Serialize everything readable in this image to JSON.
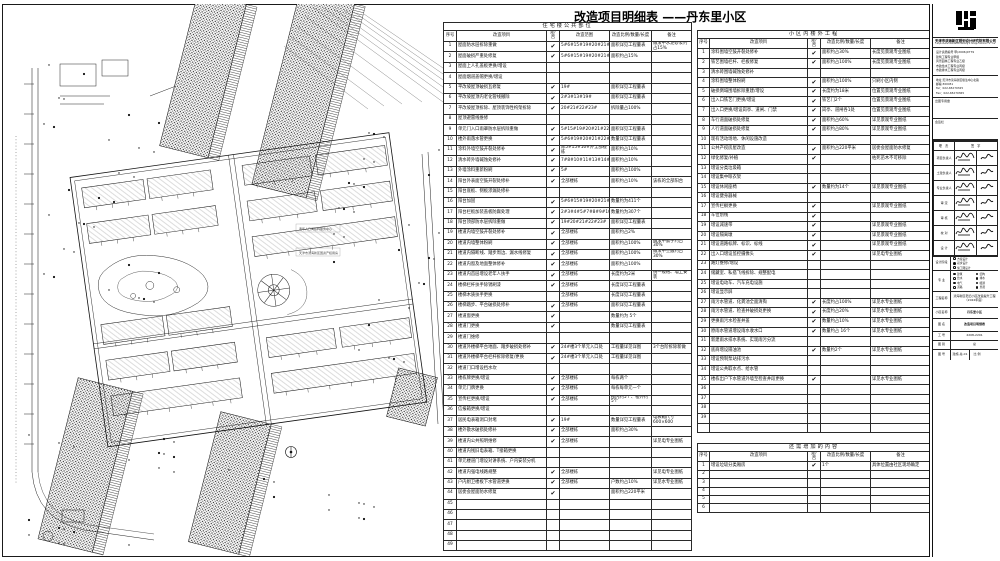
{
  "title": {
    "main": "改造项目明细表",
    "suffix": "——丹东里小区"
  },
  "left_table": {
    "title": "住宅楼公共部位",
    "headers": [
      "序号",
      "改造项目",
      "是/否",
      "改造范围",
      "改造比例/数量/长度",
      "备注"
    ],
    "rows": [
      [
        "1",
        "屋面防水层拆除重做",
        "✔",
        "5#6#15#19#20#21#22#23#",
        "面积详见工程量表",
        "做法中水泥砂浆约占15%"
      ],
      [
        "2",
        "屋面破损严重处修复",
        "✔",
        "5#6#15#19#20#21#22#23#",
        "面积约占15%",
        ""
      ],
      [
        "3",
        "屋面上人孔盖板更换/增设",
        "",
        "",
        "",
        ""
      ],
      [
        "4",
        "屋面烟道盖帽更换/增设",
        "",
        "",
        "",
        ""
      ],
      [
        "5",
        "平改坡屋顶破损瓦修复",
        "✔",
        "19#",
        "面积详见工程量表",
        ""
      ],
      [
        "6",
        "平改坡屋顶内老化管线撤除",
        "✔",
        "2#3#13#19#",
        "面积详见工程量表",
        ""
      ],
      [
        "7",
        "平改坡屋顶拆除、屋顶装饰性构架拆除",
        "✔",
        "20#21#22#23#",
        "拆除量占100%",
        ""
      ],
      [
        "8",
        "屋顶避雷线维修",
        "",
        "",
        "",
        ""
      ],
      [
        "9",
        "单元门入口雨罩防水层拆除重做",
        "✔",
        "5#15#19#20#21#22#23#",
        "面积详见工程量表",
        ""
      ],
      [
        "10",
        "楼外雨落水管更换",
        "✔",
        "5#6#19#20#21#22#23#",
        "数量详见工程量表",
        ""
      ],
      [
        "11",
        "涂料外墙空鼓开裂处修补",
        "✔",
        "除5#15#16#外全部楼栋",
        "面积约占10%",
        ""
      ],
      [
        "12",
        "清水砖外墙碱蚀处修补",
        "✔",
        "7#8#10#11#13#14#16#",
        "面积约占10%",
        ""
      ],
      [
        "13",
        "外墙涂料重新粉刷",
        "✔",
        "5#",
        "面积约占100%",
        ""
      ],
      [
        "14",
        "阳台外表面空鼓开裂处修补",
        "✔",
        "全部楼栋",
        "面积约占10%",
        "该栋的全部阳台"
      ],
      [
        "15",
        "阳台底板、侧板渗漏处修补",
        "",
        "",
        "",
        ""
      ],
      [
        "16",
        "阳台加固",
        "✔",
        "5#6#15#19#20#21#22#23#",
        "数量约为411个",
        ""
      ],
      [
        "17",
        "阳台栏板加装盖板防腐处理",
        "✔",
        "2#3#4#5#7#8#9#10#11#13#14#16#17#",
        "数量约为307个",
        ""
      ],
      [
        "18",
        "阳台顶部防水层拆除重做",
        "✔",
        "19#20#21#22#23#",
        "面积详见工程量表",
        ""
      ],
      [
        "19",
        "楼道内墙空鼓开裂处修补",
        "✔",
        "全部楼栋",
        "面积约占2%",
        ""
      ],
      [
        "20",
        "楼道内墙整体粉刷",
        "✔",
        "全部楼栋",
        "面积约占100%",
        "做法中腻子约占30%"
      ],
      [
        "21",
        "楼道内隔断线、踏步周边、漏水线修复",
        "✔",
        "全部楼栋",
        "面积约占100%",
        "做法中空鼓约占30%"
      ],
      [
        "22",
        "楼道内窗及地面整体修补",
        "✔",
        "全部楼栋",
        "面积约占100%",
        ""
      ],
      [
        "23",
        "楼道内首层增设老年人扶手",
        "✔",
        "全部楼栋",
        "长度约为2米",
        "统一规格、墙上安装"
      ],
      [
        "24",
        "楼梯栏杆扶手除锈刷漆",
        "✔",
        "全部楼栋",
        "长度详见工程量表",
        ""
      ],
      [
        "25",
        "楼梯木质扶手更换",
        "",
        "全部楼栋",
        "长度详见工程量表",
        ""
      ],
      [
        "26",
        "楼梯踏步、平台破损处修补",
        "✔",
        "全部楼栋",
        "面积详见工程量表",
        ""
      ],
      [
        "27",
        "楼道窗更换",
        "✔",
        "",
        "数量约为 5个",
        ""
      ],
      [
        "28",
        "楼道门更换",
        "✔",
        "",
        "数量详见工程量表",
        ""
      ],
      [
        "29",
        "楼道门维修",
        "",
        "",
        "",
        ""
      ],
      [
        "30",
        "楼道外楼梯平台地面、踏步破损处修补",
        "✔",
        "24#楼3个单元入口处",
        "工程量详见详图",
        "3个台阶拆除新做"
      ],
      [
        "31",
        "楼道外楼梯平台栏杆拆除修复/更换",
        "✔",
        "24#楼3个单元入口处",
        "工程量详见详图",
        ""
      ],
      [
        "32",
        "楼道门口增设挡水坎",
        "",
        "",
        "",
        ""
      ],
      [
        "33",
        "楼栋牌更换/增设",
        "✔",
        "全部楼栋",
        "每栋两个",
        ""
      ],
      [
        "34",
        "单元门牌更换",
        "✔",
        "全部楼栋",
        "每栋每单元一个",
        ""
      ],
      [
        "35",
        "宣传栏更换/增设",
        "✔",
        "全部楼栋",
        "楼内约5个、楼外约5个",
        ""
      ],
      [
        "36",
        "信报箱更换/增设",
        "",
        "",
        "",
        ""
      ],
      [
        "37",
        "居民电表箱洞口封堵",
        "✔",
        "19#",
        "数量详见工程量表",
        "电表箱尺寸600×600"
      ],
      [
        "38",
        "楼外散水破损处修补",
        "✔",
        "全部楼栋",
        "面积约占30%",
        ""
      ],
      [
        "39",
        "楼道内公共照明维修",
        "✔",
        "全部楼栋",
        "",
        "详见电专业图纸"
      ],
      [
        "40",
        "楼道内残旧电表箱、T接箱更换",
        "",
        "",
        "",
        ""
      ],
      [
        "41",
        "单元楼道门增设对讲系统、户内安装分机",
        "",
        "",
        "",
        ""
      ],
      [
        "42",
        "楼道内强电线路规整",
        "✔",
        "全部楼栋",
        "",
        "详见电专业图纸"
      ],
      [
        "43",
        "户内厨卫楼板下水管道更换",
        "✔",
        "全部楼栋",
        "户数约占10%",
        "详见水专业图纸"
      ],
      [
        "44",
        "居委会屋面防水修复",
        "✔",
        "",
        "面积约占220平米",
        ""
      ],
      [
        "45",
        "",
        "",
        "",
        "",
        ""
      ],
      [
        "46",
        "",
        "",
        "",
        "",
        ""
      ],
      [
        "47",
        "",
        "",
        "",
        "",
        ""
      ],
      [
        "48",
        "",
        "",
        "",
        "",
        ""
      ],
      [
        "49",
        "",
        "",
        "",
        "",
        ""
      ]
    ]
  },
  "right_table": {
    "title": "小区内楼外工程",
    "headers": [
      "序号",
      "改造项目",
      "是/否",
      "改造比例/数量/长度",
      "备注"
    ],
    "rows": [
      [
        "1",
        "涂料围墙空鼓开裂处修补",
        "✔",
        "面积约占30%",
        "长度见景观专业图纸"
      ],
      [
        "2",
        "铁艺围墙栏杆、栏板修复",
        "✔",
        "面积约占100%",
        "长度见景观专业图纸"
      ],
      [
        "3",
        "清水砖围墙碱蚀处修补",
        "",
        "",
        ""
      ],
      [
        "4",
        "涂料围墙整体粉刷",
        "✔",
        "面积约占100%",
        "只刷小区内侧"
      ],
      [
        "5",
        "破损倒塌围墙拆除重建/增设",
        "✔",
        "长度约为18米",
        "位置见景观专业图纸"
      ],
      [
        "6",
        "出入口铁艺门更换/增设",
        "✔",
        "铁艺门2个",
        "位置见景观专业图纸"
      ],
      [
        "7",
        "出入口更换/增设岗亭、道闸、门禁",
        "✔",
        "岗亭、道闸各1处",
        "位置见景观专业图纸"
      ],
      [
        "8",
        "车行道面破损处修复",
        "✔",
        "面积约占60%",
        "详见景观专业图纸"
      ],
      [
        "9",
        "人行道面破损处修复",
        "✔",
        "面积约占80%",
        "详见景观专业图纸"
      ],
      [
        "10",
        "现有活动场地、休闲设施改造",
        "",
        "",
        ""
      ],
      [
        "11",
        "公共产权房屋改造",
        "✔",
        "面积约占220平米",
        "居委会屋面防水修复"
      ],
      [
        "12",
        "绿化修复/补植",
        "✔",
        "",
        "枯死苗木不可移除"
      ],
      [
        "13",
        "增设分类垃圾箱",
        "",
        "",
        ""
      ],
      [
        "14",
        "增设集中晾衣架",
        "",
        "",
        ""
      ],
      [
        "15",
        "增设休闲座椅",
        "✔",
        "数量约为14个",
        "详见景观专业图纸"
      ],
      [
        "16",
        "增设健身器械",
        "",
        "",
        ""
      ],
      [
        "17",
        "宣传栏橱更换",
        "✔",
        "",
        "详见景观专业图纸"
      ],
      [
        "18",
        "车位划线",
        "✔",
        "",
        ""
      ],
      [
        "19",
        "增设减速带",
        "✔",
        "",
        "详见景观专业图纸"
      ],
      [
        "20",
        "增设隔离墩",
        "✔",
        "",
        "详见景观专业图纸"
      ],
      [
        "21",
        "增设道路标牌、标识、标线",
        "✔",
        "",
        "详见景观专业图纸"
      ],
      [
        "22",
        "出入口增设监控摄像头",
        "✔",
        "",
        "详见电专业图纸"
      ],
      [
        "23",
        "路灯维修/增设",
        "",
        "",
        ""
      ],
      [
        "24",
        "储藏室、私搭飞线拆除、规整配电",
        "",
        "",
        ""
      ],
      [
        "25",
        "增设电动车、汽车充电设施",
        "",
        "",
        ""
      ],
      [
        "26",
        "增设显示屏",
        "",
        "",
        ""
      ],
      [
        "27",
        "雨污水管道、化粪池全面清掏",
        "✔",
        "长度约占100%",
        "详见水专业图纸"
      ],
      [
        "28",
        "雨污水管道、检查井破损处更换",
        "✔",
        "长度约占20%",
        "详见水专业图纸"
      ],
      [
        "29",
        "更换雨污水检查井盖",
        "✔",
        "数量约占10%",
        "详见水专业图纸"
      ],
      [
        "30",
        "原雨水管道增设雨水收水口",
        "✔",
        "数量约占 16个",
        "详见水专业图纸"
      ],
      [
        "31",
        "新建雨水排水系统、实现雨污分流",
        "",
        "",
        ""
      ],
      [
        "32",
        "底商增设隔油池",
        "✔",
        "数量约2个",
        "详见水专业图纸"
      ],
      [
        "33",
        "增设预制泵站排污水",
        "",
        "",
        ""
      ],
      [
        "34",
        "增设公共取水点、给水管",
        "",
        "",
        ""
      ],
      [
        "35",
        "楼栋出户下水管道外墙至检查井段更换",
        "✔",
        "",
        "详见水专业图纸"
      ],
      [
        "36",
        "",
        "",
        "",
        ""
      ],
      [
        "37",
        "",
        "",
        "",
        ""
      ],
      [
        "38",
        "",
        "",
        "",
        ""
      ],
      [
        "39",
        "",
        "",
        "",
        ""
      ],
      [
        "",
        "",
        "",
        "",
        ""
      ]
    ]
  },
  "extra_table": {
    "title": "还需增加的内容",
    "headers": [
      "序号",
      "改造项目",
      "是/否",
      "改造比例/数量/长度",
      "备注"
    ],
    "rows": [
      [
        "1",
        "增设垃圾分类厢房",
        "✔",
        "1个",
        "具体位置由社区现场确定"
      ],
      [
        "2",
        "",
        "",
        "",
        ""
      ],
      [
        "3",
        "",
        "",
        "",
        ""
      ],
      [
        "4",
        "",
        "",
        "",
        ""
      ],
      [
        "5",
        "",
        "",
        "",
        ""
      ],
      [
        "6",
        "",
        "",
        "",
        ""
      ]
    ]
  },
  "titleblock": {
    "company": "天津市滨海新区规划设计研究院有限公司",
    "company_en": "Tianjin Binhai New Area Planning & Design Institute Co., Ltd.",
    "certs": [
      "设计资质编号 甲(2006)0779",
      "建筑工程专业甲级",
      "风景园林工程专业乙级",
      "市政给水工程专业丙级",
      "市政排水工程专业丙级"
    ],
    "contact": [
      "地址:天津市滨海新区塘沽中心北路",
      "邮编:300451",
      "Tel：022-65270325",
      "Fax：022-65270365"
    ],
    "box1_label": "出图专用章",
    "box2_label": "会签栏",
    "sign_header_left": "职  责",
    "sign_header_right": "签  字",
    "sign_rows": [
      "项目负责人",
      "土建负责人",
      "专业负责人",
      "审  定",
      "审  核",
      "校  对",
      "设  计"
    ],
    "stage_label": "设计阶段",
    "stage_options": [
      "方案设计",
      "初步设计",
      "施工图设计"
    ],
    "major_label": "专  业",
    "major_options": [
      "建筑",
      "结构",
      "给水",
      "排水",
      "电气",
      "暖通",
      "道路",
      "景观"
    ],
    "project_label": "工程名称",
    "project_value": "滨海新区老旧小区改造提升工程（2022年度）",
    "block_label": "小区名称",
    "block_value": "丹东里小区",
    "sheet_label": "图  名",
    "sheet_value": "改造项目明细表",
    "job_label": "工  号",
    "job_value": "2208-2201",
    "cat_label": "图  别",
    "cat_value": "总",
    "no_label": "图  号",
    "no_value": "建施-总-01",
    "scale_label": "比  例",
    "scale_value": ""
  },
  "plan": {
    "note1": "老年人日间照料服务中心",
    "note2": "天津市滨海新区国资产权用房"
  }
}
